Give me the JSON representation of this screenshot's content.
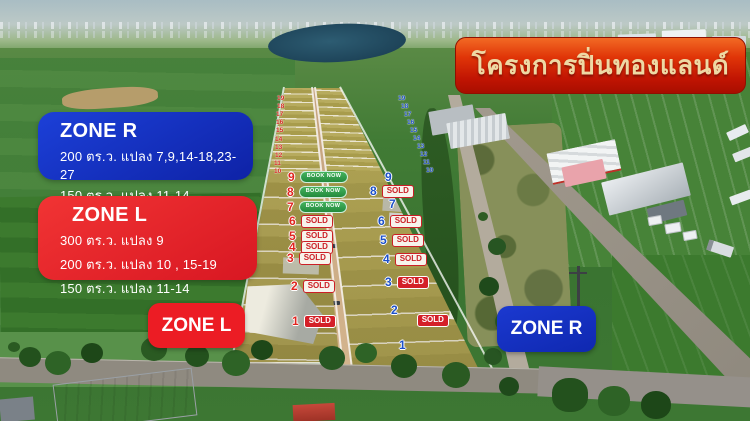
{
  "project_banner": {
    "title": "โครงการปิ่นทองแลนด์"
  },
  "zone_r_info": {
    "title": "ZONE R",
    "lines": [
      "200 ตร.ว. แปลง 7,9,14-18,23-27",
      "150 ตร.ว.  แปลง 11-14"
    ]
  },
  "zone_l_info": {
    "title": "ZONE L",
    "lines": [
      "300 ตร.ว. แปลง 9",
      "200 ตร.ว. แปลง 10 , 15-19",
      "150 ตร.ว.  แปลง 11-14"
    ]
  },
  "zone_markers": {
    "left": "ZONE L",
    "right": "ZONE R"
  },
  "plots": {
    "zone_l": [
      {
        "num": "9",
        "status": "BOOK NOW"
      },
      {
        "num": "8",
        "status": "BOOK NOW"
      },
      {
        "num": "7",
        "status": "BOOK NOW"
      },
      {
        "num": "6",
        "status": "SOLD"
      },
      {
        "num": "5",
        "status": "SOLD"
      },
      {
        "num": "4",
        "status": "SOLD"
      },
      {
        "num": "3",
        "status": "SOLD"
      },
      {
        "num": "2",
        "status": "SOLD"
      },
      {
        "num": "1",
        "status": "SOLD"
      }
    ],
    "zone_r": [
      {
        "num": "9",
        "status": ""
      },
      {
        "num": "8",
        "status": "SOLD"
      },
      {
        "num": "7",
        "status": ""
      },
      {
        "num": "6",
        "status": "SOLD"
      },
      {
        "num": "5",
        "status": "SOLD"
      },
      {
        "num": "4",
        "status": "SOLD"
      },
      {
        "num": "3",
        "status": "SOLD"
      },
      {
        "num": "2",
        "status": "SOLD"
      },
      {
        "num": "1",
        "status": ""
      }
    ]
  },
  "strip_numbers": {
    "left": [
      "19",
      "18",
      "17",
      "16",
      "15",
      "14",
      "13",
      "12",
      "11",
      "10"
    ],
    "right": [
      "19",
      "18",
      "17",
      "16",
      "15",
      "14",
      "13",
      "12",
      "11",
      "10"
    ]
  },
  "colors": {
    "banner_red": "#c01403",
    "zone_blue": "#1532c2",
    "zone_red": "#e42227",
    "sold_red": "#d42028",
    "book_green": "#2f9e4f"
  }
}
